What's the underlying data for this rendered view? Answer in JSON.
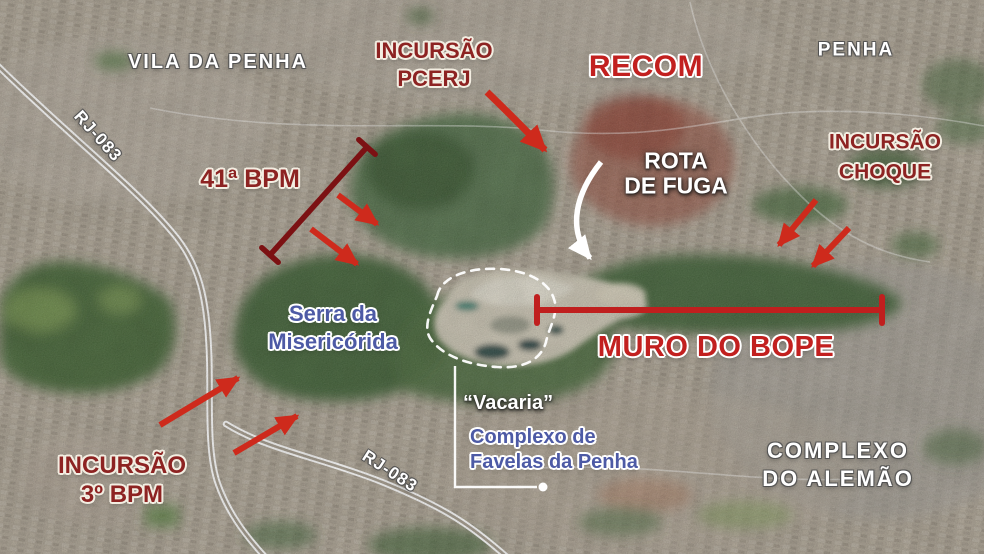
{
  "canvas": {
    "width": 984,
    "height": 554
  },
  "colors": {
    "dark_red_label": "#8d2322",
    "bright_red_label": "#c2201f",
    "arrow_red": "#ce2a1c",
    "bracket_dark_red": "#7c1113",
    "muro_line_red": "#c01f1e",
    "blue_label": "#4d5aa5",
    "white_label": "#ffffff"
  },
  "places": {
    "vila_da_penha": "VILA DA PENHA",
    "penha": "PENHA",
    "complexo_do_alemao": {
      "line1": "COMPLEXO",
      "line2": "DO ALEMÃO"
    },
    "serra": {
      "line1": "Serra da",
      "line2": "Misericórida"
    },
    "vacaria": "“Vacaria”",
    "favela_complex": {
      "line1": "Complexo de",
      "line2": "Favelas da Penha"
    }
  },
  "roads": {
    "rj083_top": "RJ-083",
    "rj083_bottom": "RJ-083"
  },
  "operations": {
    "incursao_pcerj": {
      "line1": "INCURSÃO",
      "line2": "PCERJ"
    },
    "recom": "RECOM",
    "incursao_choque": {
      "line1": "INCURSÃO",
      "line2": "CHOQUE"
    },
    "bpm41": "41ª BPM",
    "incursao_3bpm": {
      "line1": "INCURSÃO",
      "line2": "3º BPM"
    },
    "muro_do_bope": "MURO DO BOPE",
    "rota_de_fuga": {
      "line1": "ROTA",
      "line2": "DE FUGA"
    }
  },
  "annotations": [
    {
      "name": "pcerj-attack-arrow",
      "type": "curved-arrow",
      "color": "#ce2a1c"
    },
    {
      "name": "bpm41-front-line",
      "type": "capped-line",
      "color": "#7c1113"
    },
    {
      "name": "bpm41-attack-arrows",
      "type": "arrow-pair",
      "color": "#ce2a1c"
    },
    {
      "name": "choque-attack-arrows",
      "type": "arrow-pair",
      "color": "#ce2a1c"
    },
    {
      "name": "bpm3-attack-arrows",
      "type": "arrow-pair",
      "color": "#ce2a1c"
    },
    {
      "name": "rota-de-fuga-arrow",
      "type": "curved-arrow",
      "color": "#ffffff"
    },
    {
      "name": "muro-do-bope-line",
      "type": "capped-line",
      "color": "#c01f1e"
    },
    {
      "name": "vacaria-area-outline",
      "type": "dashed-outline",
      "color": "#ffffff"
    },
    {
      "name": "vacaria-leader-line",
      "type": "leader-line",
      "color": "#ffffff"
    }
  ]
}
